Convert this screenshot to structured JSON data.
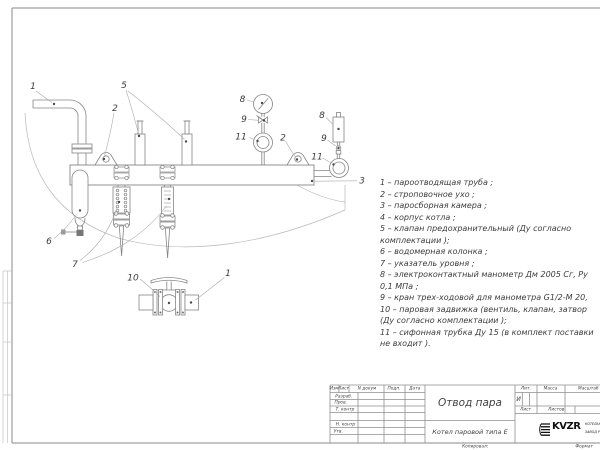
{
  "sheet": {
    "background": "#ffffff",
    "line_color": "#858585",
    "text_color": "#3c3c3c"
  },
  "drawing": {
    "callouts": [
      {
        "part": "steam-outlet-pipe",
        "label": "1"
      },
      {
        "part": "lifting-lug-left",
        "label": "2"
      },
      {
        "part": "safety-valves",
        "label": "5"
      },
      {
        "part": "pressure-gauge",
        "label": "8"
      },
      {
        "part": "three-way-cock-left",
        "label": "9"
      },
      {
        "part": "siphon-tube-left",
        "label": "11"
      },
      {
        "part": "lifting-lug-right",
        "label": "2"
      },
      {
        "part": "electrocontact-manometer",
        "label": "8"
      },
      {
        "part": "three-way-cock-right",
        "label": "9"
      },
      {
        "part": "siphon-tube-right",
        "label": "11"
      },
      {
        "part": "steam-collecting-chamber",
        "label": "3"
      },
      {
        "part": "water-gauge-column",
        "label": "6"
      },
      {
        "part": "level-indicator",
        "label": "7"
      },
      {
        "part": "steam-gate-valve",
        "label": "10"
      },
      {
        "part": "steam-outlet-pipe-bottom",
        "label": "1"
      }
    ]
  },
  "legend": {
    "lines": [
      "1 – пароотводящая труба ;",
      "2 – строповочное ухо ;",
      "3 – паросборная камера ;",
      "4 – корпус котла ;",
      "5 – клапан предохранительный  (Ду согласно",
      "комплектации );",
      "6 – водомерная колонка ;",
      "7 – указатель уровня ;",
      "8 – электроконтактный манометр  Дм 2005 Сг,  Ру",
      "0,1 МПа ;",
      "9 – кран трех-ходовой для манометра  G1/2-М 20,",
      "10 – паровая задвижка  (вентиль, клапан, затвор",
      "(Ду согласно комплектации );",
      "11 – сифонная трубка Ду 15 (в комплект поставки",
      "не входит )."
    ]
  },
  "title_block": {
    "header": {
      "izm": "Изм",
      "list": "Лист",
      "ndoc": "N докум",
      "podp": "Подп.",
      "data": "Дата"
    },
    "rows": {
      "razrab": "Разраб.",
      "prov": "Пров.",
      "tkontr": "Т. контр",
      "nkontr": "Н. контр",
      "utv": "Утв."
    },
    "doc_title": "Отвод пара",
    "doc_subtitle": "Котел паровой типа Е",
    "lit_header": "Лит.",
    "lit_value": "И",
    "massa_header": "Масса",
    "masshtab_header": "Масштаб",
    "list_label": "Лист",
    "listov_label": "Листов",
    "logo_text": "KVZR",
    "org_line1": "КОТЕЛЬН",
    "org_line2": "ЗАВОД Р",
    "kopiroval": "Копировал:",
    "format": "Формат"
  }
}
